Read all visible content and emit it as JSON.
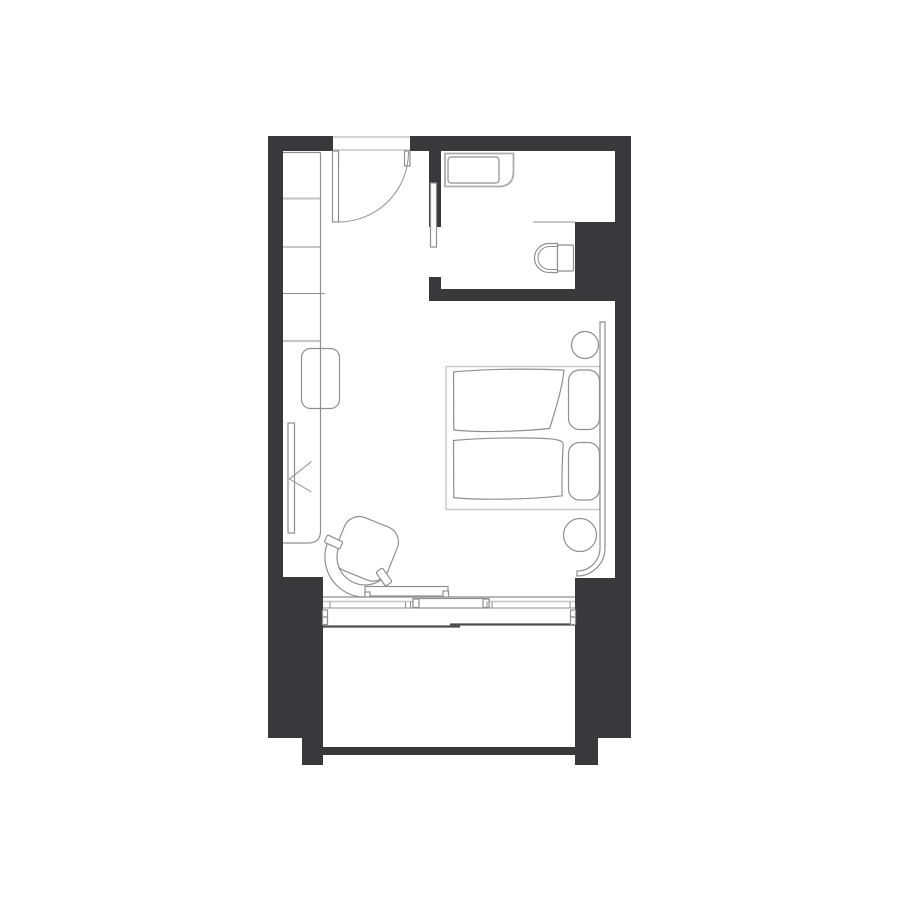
{
  "colors": {
    "background": "#ffffff",
    "wall": "#39393b",
    "line": "#8f8f91",
    "line-light": "#c6c6c8",
    "line-strong": "#4e4e50"
  },
  "plan": {
    "type": "floor-plan",
    "drawing": "hotel-guest-room",
    "rooms": [
      {
        "id": "entry",
        "features": [
          "entry-door-swing",
          "wardrobe-shelves"
        ]
      },
      {
        "id": "bathroom",
        "features": [
          "vanity-counter",
          "sink-basin",
          "pocket-door",
          "toilet",
          "service-pier"
        ]
      },
      {
        "id": "bedroom",
        "features": [
          "double-bed",
          "duvet-left",
          "duvet-right",
          "pillow-left",
          "pillow-right",
          "curved-headboard",
          "round-side-table-top",
          "round-side-table-bottom",
          "desk-counter",
          "stool",
          "wall-tv",
          "tv-bracket",
          "lounge-chair"
        ]
      },
      {
        "id": "balcony",
        "features": [
          "sliding-window-panels",
          "window-frame",
          "parapet-wall"
        ]
      }
    ]
  }
}
